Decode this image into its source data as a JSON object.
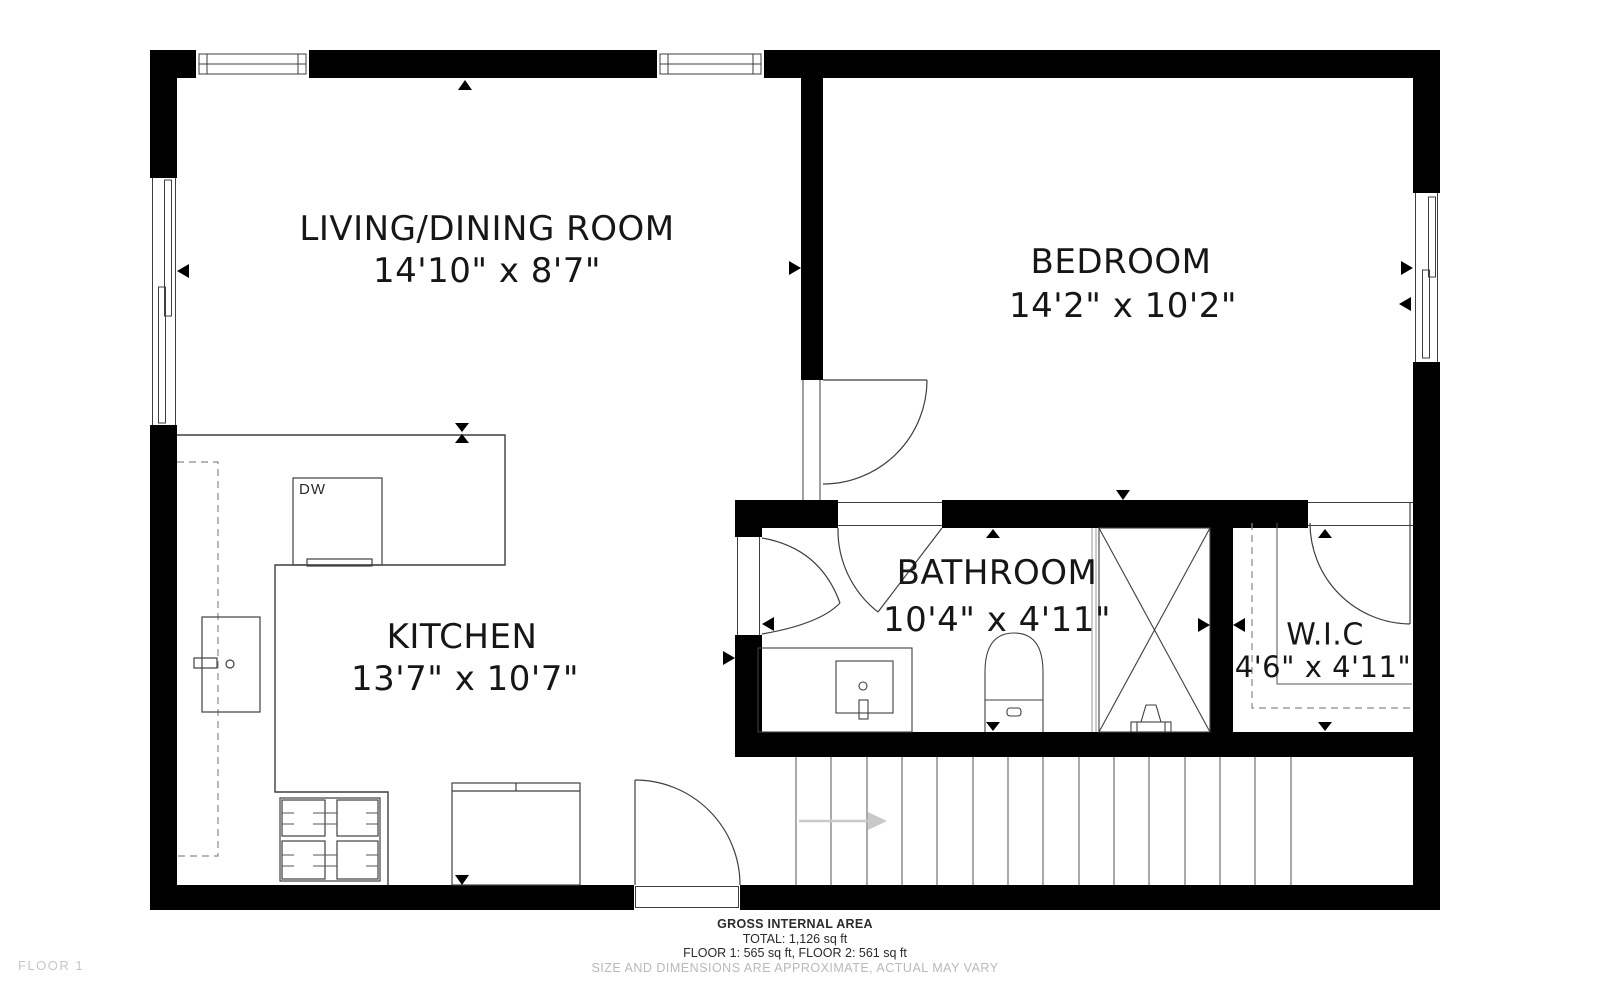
{
  "plan": {
    "rooms": [
      {
        "name": "LIVING/DINING ROOM",
        "dims": "14'10\" x 8'7\""
      },
      {
        "name": "BEDROOM",
        "dims": "14'2\" x 10'2\""
      },
      {
        "name": "KITCHEN",
        "dims": "13'7\" x 10'7\""
      },
      {
        "name": "BATHROOM",
        "dims": "10'4\" x 4'11\""
      },
      {
        "name": "W.I.C",
        "dims": "4'6\" x 4'11\""
      }
    ],
    "labels": {
      "dishwasher": "DW"
    },
    "footer": {
      "title": "GROSS INTERNAL AREA",
      "total": "TOTAL: 1,126 sq ft",
      "floors": "FLOOR 1: 565 sq ft, FLOOR 2: 561 sq ft",
      "disclaimer": "SIZE AND DIMENSIONS ARE APPROXIMATE, ACTUAL MAY VARY"
    },
    "floor_label": "FLOOR 1",
    "colors": {
      "wall": "#000000",
      "line": "#3f3f3f",
      "stairs": "#555555",
      "dashed": "#8a8a8a",
      "glass": "#999999",
      "arrow": "#c9c9c9",
      "muted_text": "#b9b9b9",
      "floor_text": "#c6c6c6"
    }
  }
}
